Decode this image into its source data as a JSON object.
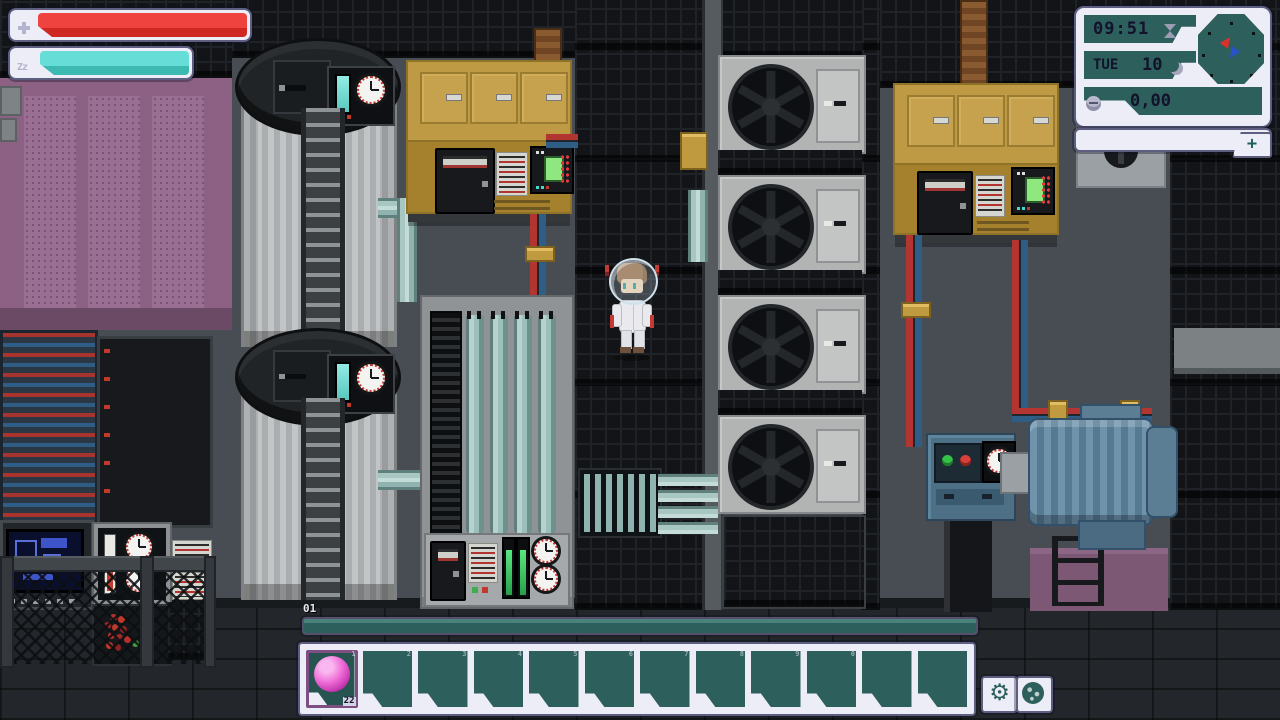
{
  "palette": {
    "health_red": "#e8312e",
    "energy_teal": "#5fd9d2",
    "hud_frame": "#ededf8",
    "hud_border": "#5e5e80",
    "panel_teal": "#2d5f5c",
    "selected_slot_border": "#7d4f82",
    "item_pink": "#e557d4",
    "xp_fill_teal": "#2d5f5c"
  },
  "hud": {
    "health_bar": {
      "fill": 1.0,
      "icon": "cross"
    },
    "energy_bar": {
      "fill": 1.0,
      "icon": "sleep-zz"
    },
    "clock_panel": {
      "time": "09:51",
      "day": "TUE",
      "date": "10",
      "money": "0,00",
      "hourglass_icon": "hourglass",
      "moon_icon": "moon-phase",
      "coin_icon": "coin",
      "radar_markers": [
        "red",
        "blue"
      ]
    },
    "expand_button_label": "+",
    "level_label": "01",
    "hotbar": {
      "selected_index": 0,
      "slots": [
        {
          "num": "1",
          "item": "pink-orb",
          "count": "22"
        },
        {
          "num": "2"
        },
        {
          "num": "3"
        },
        {
          "num": "4"
        },
        {
          "num": "5"
        },
        {
          "num": "6"
        },
        {
          "num": "7"
        },
        {
          "num": "8"
        },
        {
          "num": "9"
        },
        {
          "num": "0"
        },
        {
          "num": ""
        },
        {
          "num": ""
        }
      ]
    },
    "settings_button_glyph": "⚙",
    "sleep_icon_text": "Zz"
  }
}
